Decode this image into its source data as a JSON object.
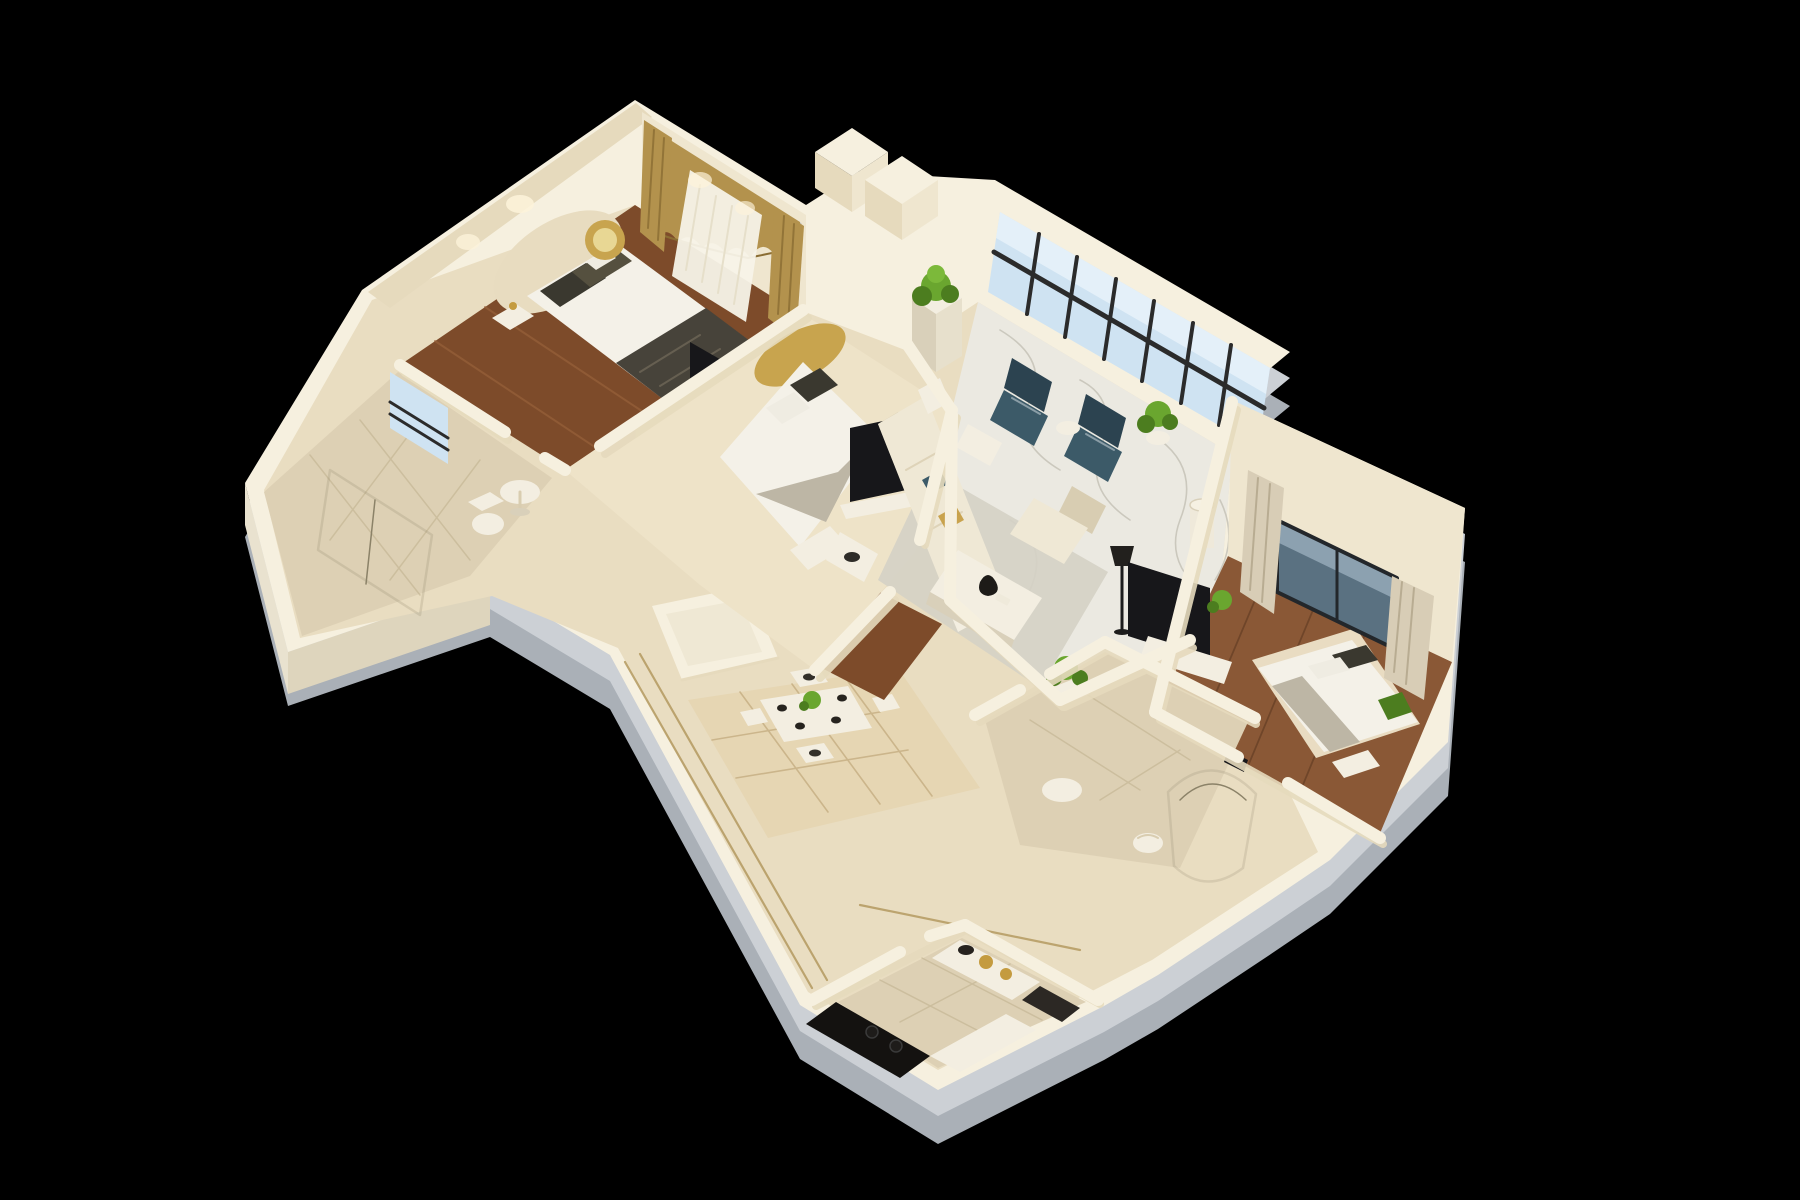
{
  "scene": {
    "title": "3D isometric cutaway render of a furnished apartment floor plan on a black background",
    "style": "dollhouse top-down isometric render, no visible text",
    "background": "#000000",
    "rooms": [
      {
        "name": "bedroom-1",
        "position": "top-left",
        "floor": "dark walnut wood planks",
        "furniture": [
          "double bed with white duvet and charcoal runner",
          "cream curved headboard",
          "dark patterned pillows",
          "gold round wall mirror",
          "white nightstand",
          "foot bench",
          "black tv panel",
          "gold blackout curtains with white sheer on rod"
        ]
      },
      {
        "name": "living-room",
        "position": "top-right",
        "floor": "white marble with gray veining",
        "furniture": [
          "floor-to-ceiling window wall with black mullions",
          "two dark teal armchairs",
          "potted plants on white pedestals",
          "cream three-seat sofa with teal and gold pillows",
          "white ottoman coffee table",
          "cream armchair",
          "white side tables",
          "black floor lamp",
          "warm gray area rug"
        ]
      },
      {
        "name": "bedroom-2",
        "position": "center",
        "floor": "cream stone with wood patches",
        "furniture": [
          "double bed with gold curved headboard",
          "white duvet with gray runner",
          "dark pillows",
          "black tv panel",
          "white media cabinet",
          "foot bench"
        ]
      },
      {
        "name": "master-bedroom",
        "position": "right",
        "floor": "walnut wood with cream rug",
        "furniture": [
          "double bed with white duvet",
          "dark pillows",
          "green throw blanket",
          "slate picture window",
          "beige curtains",
          "white tv console with black tv",
          "white drum lamp",
          "potted plant",
          "foot bench"
        ]
      },
      {
        "name": "bathroom-1",
        "position": "left wing",
        "floor": "beige tile",
        "furniture": [
          "glass shower enclosure",
          "white toilet",
          "light blue framed window"
        ]
      },
      {
        "name": "bathroom-2",
        "position": "bottom-right",
        "floor": "beige tile",
        "furniture": [
          "curved glass shower",
          "white toilet",
          "round white side table",
          "potted plant on stand",
          "dark towel fixture"
        ]
      },
      {
        "name": "dining-area",
        "position": "bottom-center",
        "floor": "cream marble with diamond-pattern rug",
        "furniture": [
          "white dining table with dark place settings",
          "green centerpiece",
          "four cream chairs"
        ]
      },
      {
        "name": "kitchen",
        "position": "bottom protrusion",
        "floor": "beige tile",
        "furniture": [
          "black counter with cooktop rings",
          "brass pots and dark pan",
          "white counters",
          "dark cabinet"
        ]
      },
      {
        "name": "storage-room",
        "position": "center-left",
        "floor": "cream",
        "furniture": [
          "small empty white-walled closet"
        ]
      },
      {
        "name": "hallway",
        "position": "center",
        "floor": "cream marble with gold inlay border lines",
        "furniture": [
          "white round side table"
        ]
      }
    ],
    "palette": {
      "background": "#000000",
      "slab_dark": "#aab0b7",
      "slab_light": "#ccd0d5",
      "wall_top": "#f6f0df",
      "wall_face": "#efe6cf",
      "wall_face_shadow": "#e6dabd",
      "glow": "#fdf3da",
      "wood": "#7d4b2a",
      "wood_light": "#97613a",
      "wood_dark": "#5e3a22",
      "wood_master": "#8a5836",
      "marble": "#ebe9e1",
      "marble_vein": "#c8c5ba",
      "hall_floor": "#e9ddc1",
      "bedroom2_floor": "#eee3c8",
      "gold_line": "#b49a60",
      "bath_tile": "#ddd0b4",
      "tile_line": "#c5b795",
      "window_glass": "#cfe3f2",
      "mullion": "#2b2b2b",
      "master_glass": "#5a7181",
      "master_glass_high": "#9db2c0",
      "curtain_gold": "#b3924d",
      "curtain_gold_dark": "#8a6d33",
      "sheer_white": "#f7f3e8",
      "curtain_beige": "#d8cdb6",
      "bed_white": "#f4f1e8",
      "blanket_dark": "#47433a",
      "blanket_gray": "#bdb6a5",
      "pillow_dark": "#3a382f",
      "headboard_gold": "#c8a44e",
      "headboard_cream": "#e8dcc0",
      "sofa_cream": "#efe8d5",
      "sofa_shadow": "#d8cdb2",
      "teal": "#3c5a68",
      "teal_dark": "#2c4350",
      "plant_green": "#6aa62f",
      "plant_dark": "#4c7d1f",
      "white_furniture": "#f3eee1",
      "furniture_shadow": "#d9d0ba",
      "tv_black": "#17171a",
      "stove_black": "#141210",
      "pot_gold": "#c49b3f",
      "rug_gray": "#d5d1c6",
      "rug_cream": "#e6d6b3",
      "rug_line": "#c9b287",
      "glass_frame": "#8b8268"
    }
  }
}
